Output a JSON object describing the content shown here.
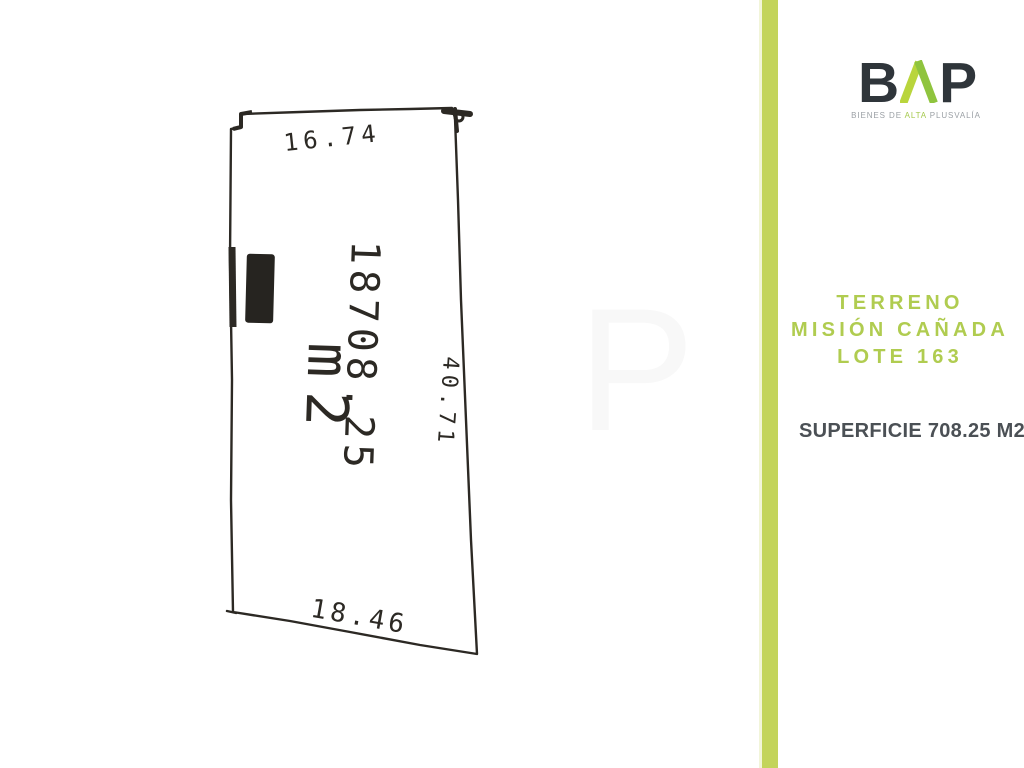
{
  "brand": {
    "letter_b": "B",
    "letter_p": "P",
    "tagline": {
      "pre": "BIENES DE ",
      "highlight": "ALTA",
      "post": " PLUSVALÍA"
    },
    "colors": {
      "dark": "#2f353a",
      "caret_green_left": "#b9d53c",
      "caret_green_right": "#8fc43e",
      "tagline_gray": "#9ba0a5",
      "tagline_green": "#a5c94c"
    }
  },
  "listing": {
    "title_lines": [
      "TERRENO",
      "MISIÓN CAÑADA",
      "LOTE 163"
    ],
    "title_color": "#b0cc50",
    "surface": "SUPERFICIE 708.25 M2",
    "surface_color": "#4b5055"
  },
  "divider": {
    "color": "#c3d45b"
  },
  "survey_plan": {
    "dimensions": {
      "top": "16.74",
      "right": "40.71",
      "bottom": "18.46"
    },
    "area": {
      "value": "18708.25",
      "unit": "m2"
    },
    "watermark": "P",
    "ink_color": "#2c2924"
  }
}
